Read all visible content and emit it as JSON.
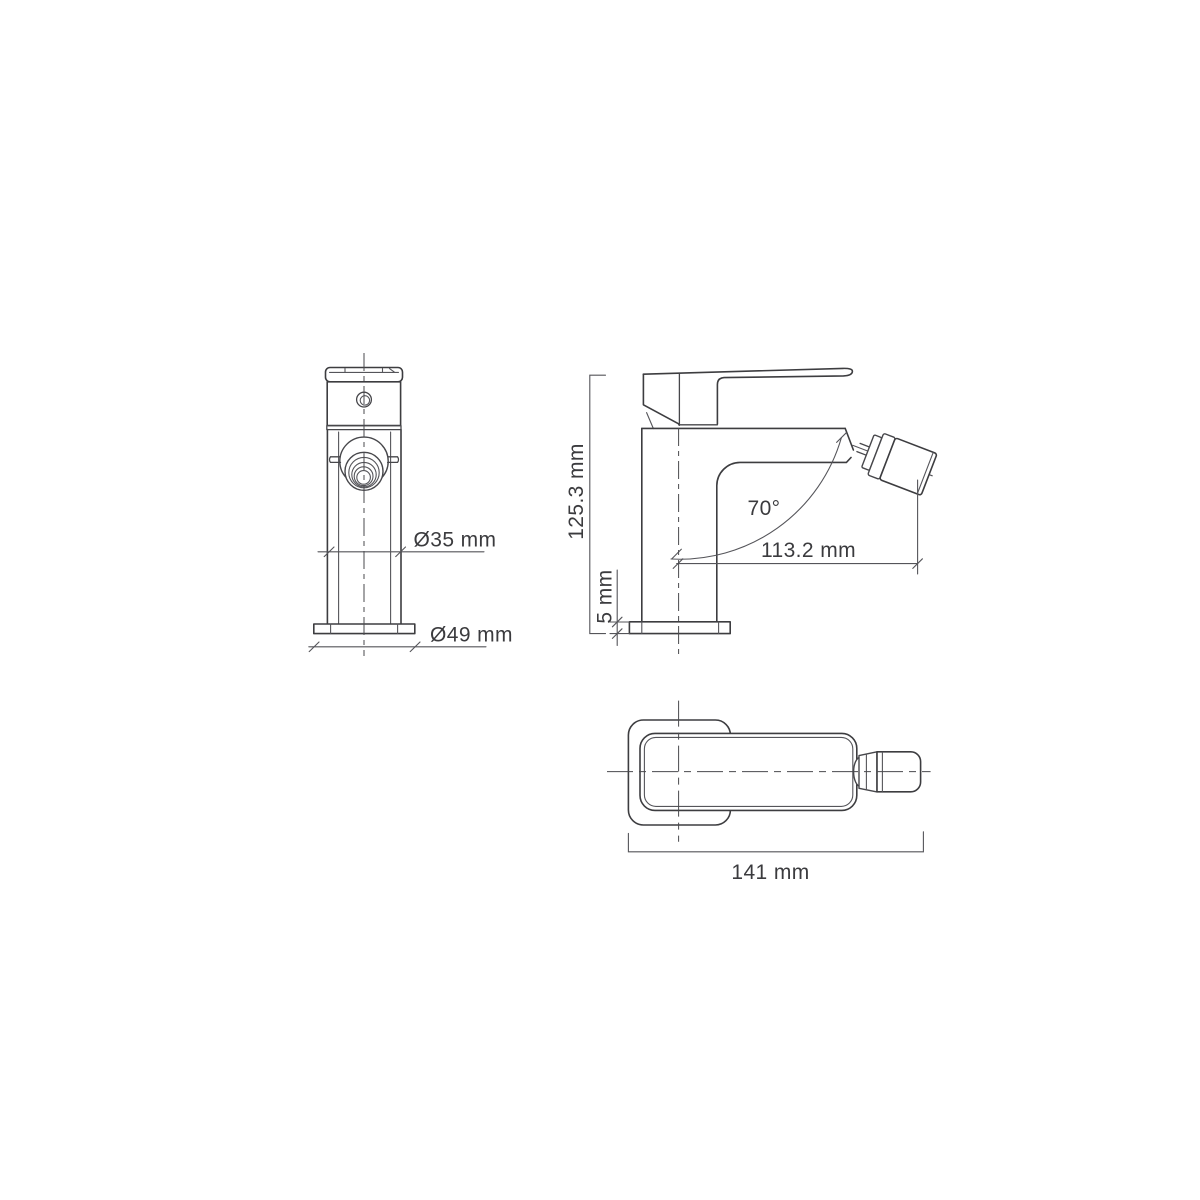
{
  "canvas": {
    "background": "#ffffff",
    "line_color": "#3d3d40",
    "dim_line_color": "#55555a",
    "text_color": "#3b3b3e"
  },
  "views": {
    "front": {
      "dims": {
        "body_diameter": "Ø35 mm",
        "base_diameter": "Ø49 mm"
      }
    },
    "side": {
      "dims": {
        "total_height": "125.3 mm",
        "base_height": "5 mm",
        "spout_angle": "70°",
        "spout_reach": "113.2 mm"
      }
    },
    "top": {
      "dims": {
        "total_length": "141 mm"
      }
    }
  }
}
